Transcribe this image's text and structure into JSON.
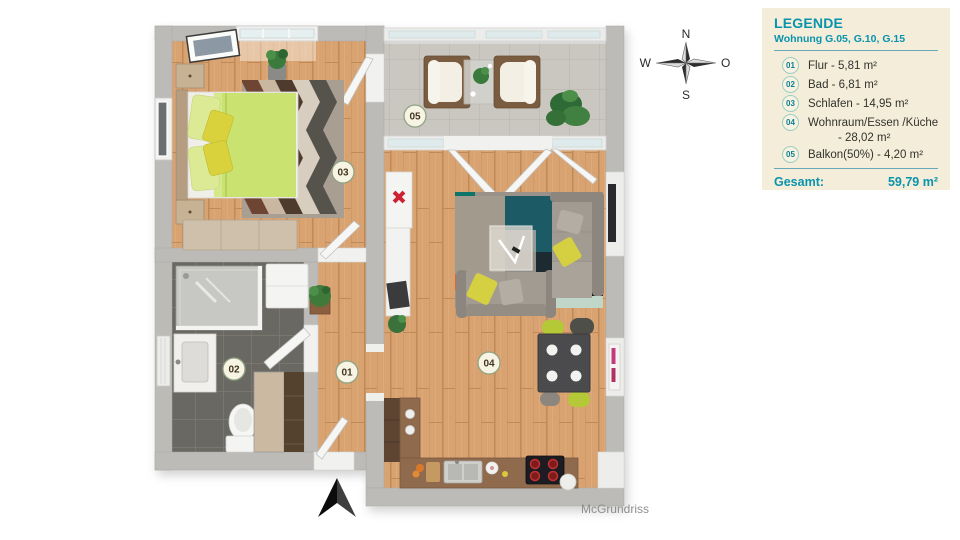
{
  "legend": {
    "title": "LEGENDE",
    "subtitle": "Wohnung G.05, G.10, G.15",
    "items": [
      {
        "num": "01",
        "label": "Flur - 5,81 m²"
      },
      {
        "num": "02",
        "label": "Bad - 6,81 m²"
      },
      {
        "num": "03",
        "label": "Schlafen - 14,95 m²"
      },
      {
        "num": "04",
        "label": "Wohnraum/Essen /Küche",
        "label2": "- 28,02 m²"
      },
      {
        "num": "05",
        "label": "Balkon(50%) - 4,20 m²"
      }
    ],
    "total_label": "Gesamt:",
    "total_value": "59,79 m²"
  },
  "compass": {
    "north": "N",
    "east": "O",
    "south": "S",
    "west": "W"
  },
  "rooms": [
    {
      "num": "01",
      "name": "Flur"
    },
    {
      "num": "02",
      "name": "Bad"
    },
    {
      "num": "03",
      "name": "Schlafen"
    },
    {
      "num": "04",
      "name": "Wohnraum/Essen/Küche"
    },
    {
      "num": "05",
      "name": "Balkon"
    }
  ],
  "watermark": "McGrundriss",
  "colors": {
    "legend_bg": "#f3edda",
    "legend_accent": "#0a93ad",
    "legend_text": "#33322c",
    "badge_ring": "#9ccfc3",
    "wall": "#bcbbb8",
    "wood_floor": "#d9a271",
    "bath_tile": "#6b6862",
    "balcony_tile": "#c9c7c0",
    "bed_duvet": "#c9e26f",
    "accent_yellow": "#d5d043",
    "room_label_ring": "#8fa383"
  }
}
